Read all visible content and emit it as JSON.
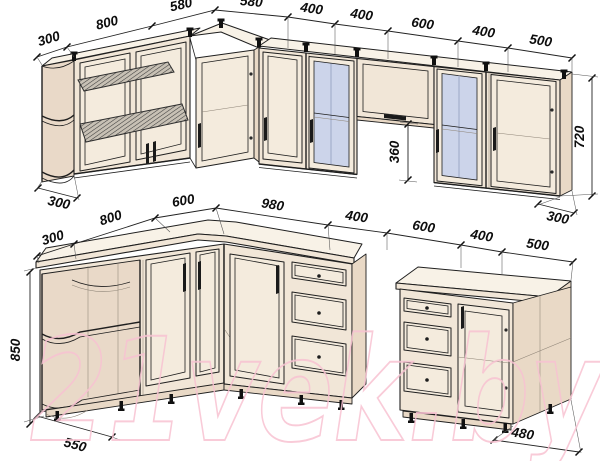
{
  "colors": {
    "cabinet": "#f1e6d7",
    "cabinet_top": "#f8f2e7",
    "side": "#e9d9c6",
    "interior": "#e9d9c8",
    "door": "#f4ebdd",
    "glass": "#ccd4ea",
    "line": "#1f1f1f",
    "watermark": "#f8c2d2"
  },
  "watermark": {
    "text": "21vek.by"
  },
  "upper": {
    "dims": [
      "300",
      "800",
      "580",
      "580",
      "400",
      "400",
      "600",
      "400",
      "500"
    ],
    "height": "720",
    "open_height": "360",
    "left_depth": "300",
    "right_depth": "300"
  },
  "lower": {
    "dims": [
      "300",
      "800",
      "600",
      "980",
      "400",
      "600",
      "400",
      "500"
    ],
    "height": "850",
    "left_depth": "550",
    "right_depth": "480"
  }
}
